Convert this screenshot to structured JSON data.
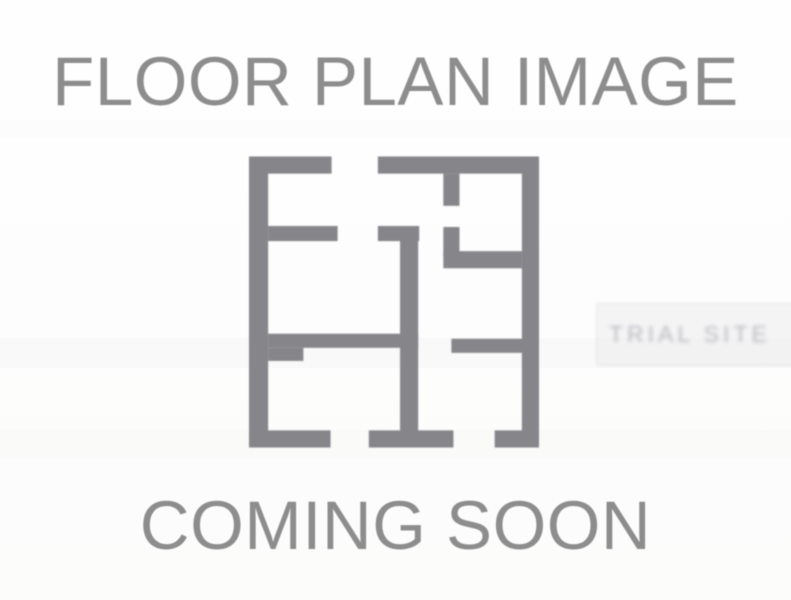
{
  "placeholder": {
    "title": "FLOOR PLAN IMAGE",
    "subtitle": "COMING SOON",
    "text_color": "#8d8d8e",
    "background_color": "#fdfdfd",
    "icon": {
      "name": "floor-plan-icon",
      "color": "#85858a"
    },
    "watermark": {
      "text": "TRIAL SITE",
      "color": "#7d7d86"
    }
  }
}
